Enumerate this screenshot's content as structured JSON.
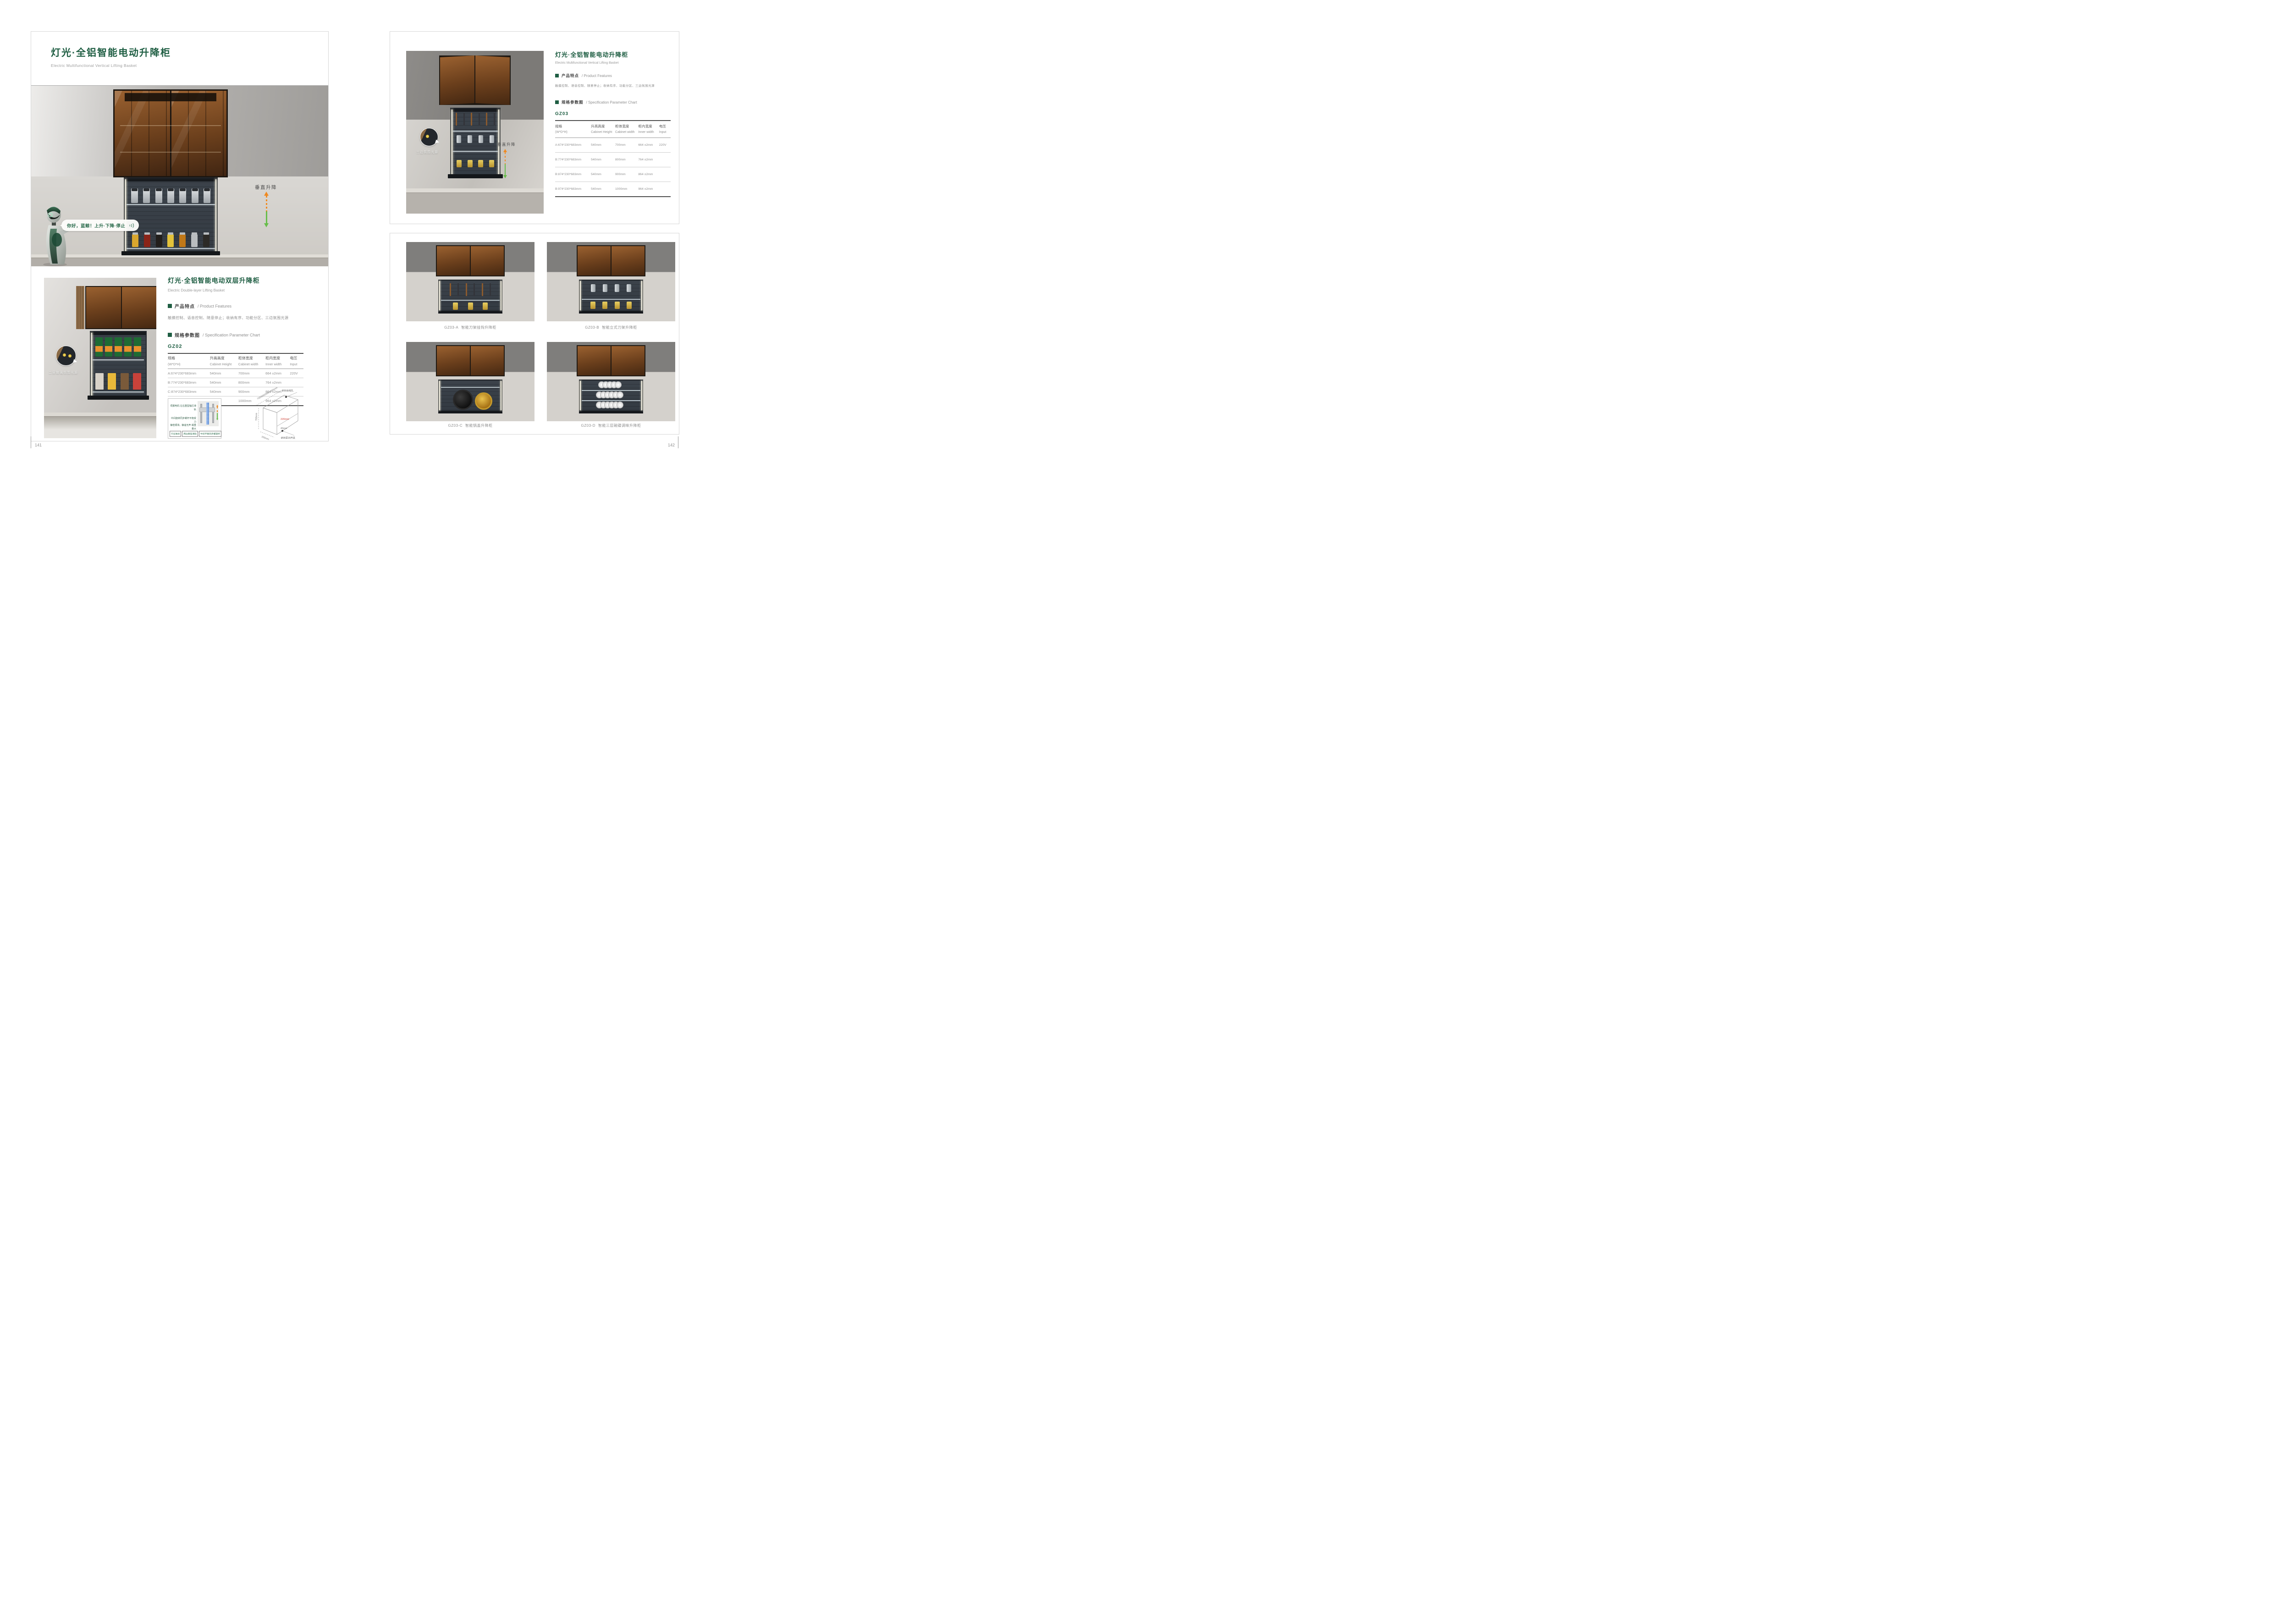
{
  "colors": {
    "brand_green": "#1f5e43",
    "text_gray": "#8f8f8f",
    "arrow_orange": "#f0891f",
    "arrow_green": "#67bd4a",
    "dimension_red": "#d0392e"
  },
  "left_page": {
    "page_number": "141",
    "title": "灯光·全铝智能电动升降柜",
    "subtitle": "Electric Multifunctional Vertical Lifting Basket",
    "hero": {
      "speech_text": "你好，蓝鲸！上升·下降·停止",
      "lift_label": "垂直升降"
    },
    "section": {
      "title": "灯光·全铝智能电动双层升降柜",
      "subtitle": "Electric Double-layer Lifting Basket",
      "features_zh": "产品特点",
      "features_en": "/ Product Features",
      "features_text": "触摸控制、语音控制、随意停止；收纳有序、功能分区、三边氛围光源",
      "spec_zh": "规格参数图",
      "spec_en": "/ Specification Parameter Chart",
      "model": "GZ02",
      "callout_label": "二层玻璃氛围光源",
      "table": {
        "headers": [
          {
            "zh": "规格",
            "en": "(W*D*H)"
          },
          {
            "zh": "升高高度",
            "en": "Cabinet Height"
          },
          {
            "zh": "柜体宽度",
            "en": "Cabinet width"
          },
          {
            "zh": "柜内宽度",
            "en": "Inner width"
          },
          {
            "zh": "电压",
            "en": "Input"
          }
        ],
        "rows": [
          [
            "A:674*230*683mm",
            "540mm",
            "700mm",
            "664 ±2mm",
            "220V"
          ],
          [
            "B:774*230*683mm",
            "540mm",
            "800mm",
            "764 ±2mm",
            ""
          ],
          [
            "C:874*230*683mm",
            "540mm",
            "900mm",
            "864 ±2mm",
            ""
          ],
          [
            "D:974*230*683mm",
            "540mm",
            "1000mm",
            "964 ±2mm",
            ""
          ]
        ]
      },
      "mech_diagram": {
        "label_rails": "伺服电机·左右重型轴芯滑轨",
        "label_screw_1": "中间旋转同步螺杆平衡受力",
        "label_screw_2": "静密顺滑，静谧无声·载重量大",
        "chips": [
          "行业独创",
          "两边重型滑轨",
          "中间平衡同步螺旋杆"
        ]
      },
      "sketch": {
        "width_options": "700/800/900/1000mm",
        "height": "700mm",
        "depth": "330mm",
        "clearance": "220mm",
        "offset": "46mm",
        "hole_label": "Ø35出线孔",
        "switch_label": "Ø35深15开关"
      }
    }
  },
  "right_page": {
    "page_number": "142",
    "title": "灯光·全铝智能电动升降柜",
    "subtitle": "Electric Multifunctional Vertical Lifting Basket",
    "features_zh": "产品特点",
    "features_en": "/ Product Features",
    "features_text": "触摸控制、语音控制、随意停止；收纳有序、功能分区、三边氛围光源",
    "spec_zh": "规格参数图",
    "spec_en": "/ Specification Parameter Chart",
    "model": "GZ03",
    "photo": {
      "callout_label": "三边氛围光源",
      "lift_label": "垂直升降"
    },
    "table": {
      "headers": [
        {
          "zh": "规格",
          "en": "(W*D*H)"
        },
        {
          "zh": "升高高度",
          "en": "Cabinet Height"
        },
        {
          "zh": "柜体宽度",
          "en": "Cabinet width"
        },
        {
          "zh": "柜内宽度",
          "en": "Inner width"
        },
        {
          "zh": "电压",
          "en": "Input"
        }
      ],
      "rows": [
        [
          "A:674*230*683mm",
          "540mm",
          "700mm",
          "664 ±2mm",
          "220V"
        ],
        [
          "B:774*230*683mm",
          "540mm",
          "800mm",
          "764 ±2mm",
          ""
        ],
        [
          "B:874*230*683mm",
          "540mm",
          "900mm",
          "864 ±2mm",
          ""
        ],
        [
          "B:974*230*683mm",
          "540mm",
          "1000mm",
          "964 ±2mm",
          ""
        ]
      ]
    },
    "products": [
      {
        "code": "GZ03-A",
        "name": "智能刀架挂钩升降柜"
      },
      {
        "code": "GZ03-B",
        "name": "智能立式刀架升降柜"
      },
      {
        "code": "GZ03-C",
        "name": "智能锅盖升降柜"
      },
      {
        "code": "GZ03-D",
        "name": "智能三层碗碟调味升降柜"
      }
    ]
  }
}
